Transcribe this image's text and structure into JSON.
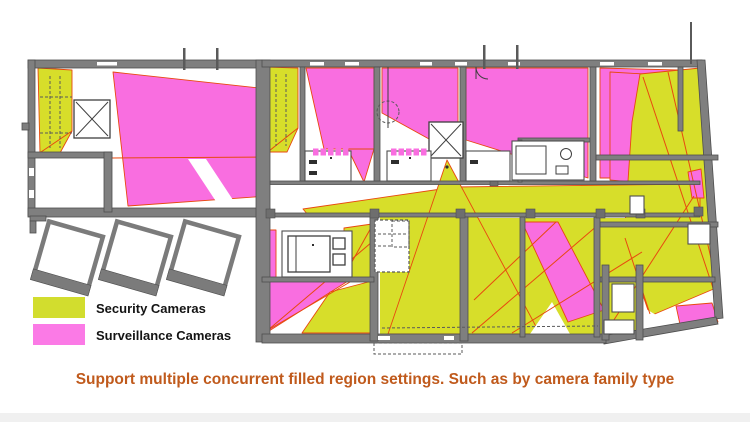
{
  "caption": {
    "text": "Support multiple concurrent filled region settings. Such as by camera family type",
    "color": "#c05a1c"
  },
  "legend": {
    "items": [
      {
        "label": "Security Cameras",
        "color": "#d2dd2e"
      },
      {
        "label": "Surveillance Cameras",
        "color": "#fb7ae6"
      }
    ]
  },
  "colors": {
    "background": "#ffffff",
    "wall": "#7f7f7f",
    "wallStroke": "#4e4e4e",
    "security": "#d7de2a",
    "surveillance": "#f96ee0",
    "sightline": "#e8490f",
    "legendText": "#141414"
  }
}
